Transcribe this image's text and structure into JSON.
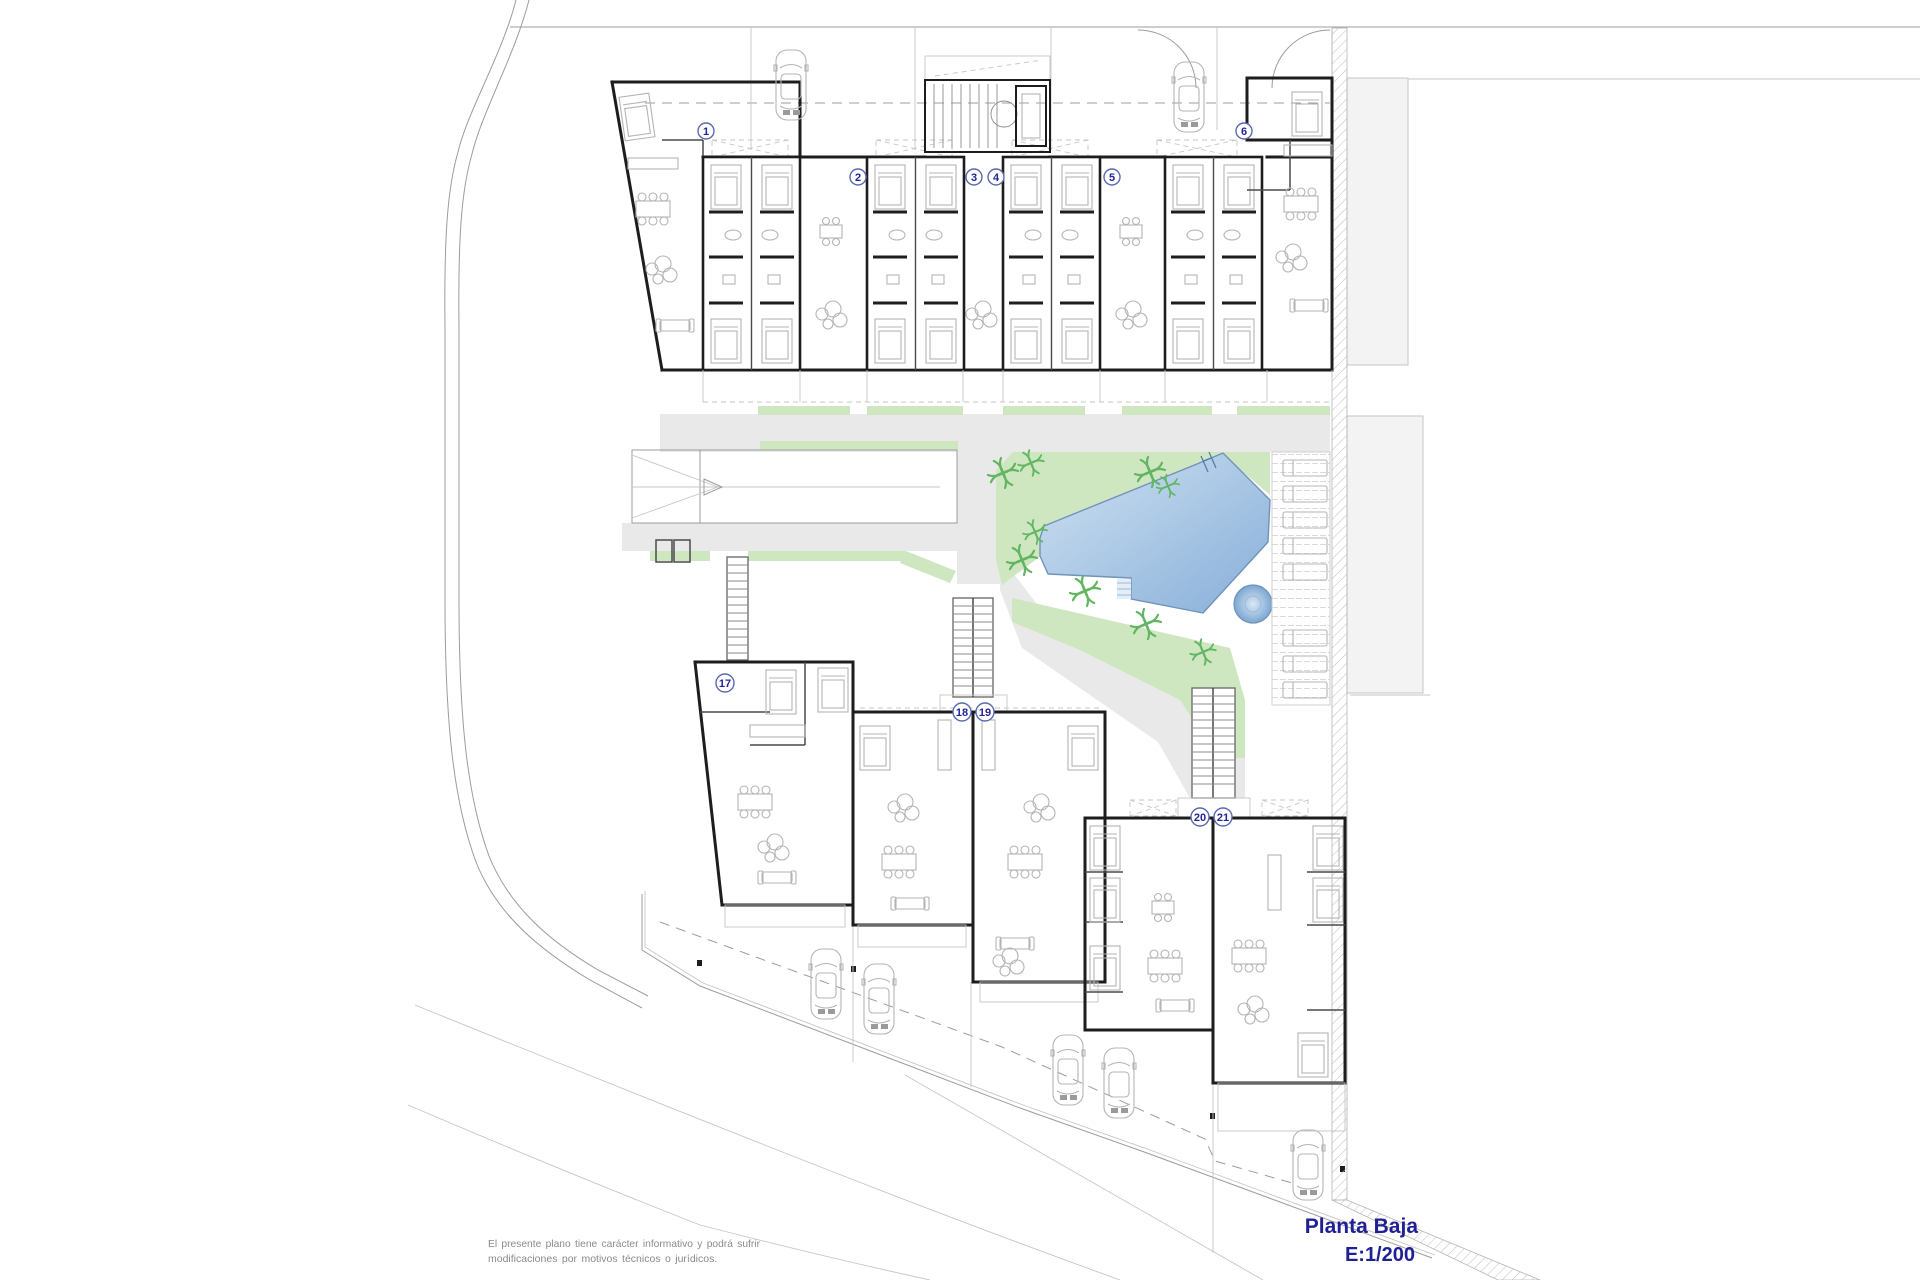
{
  "title_block": {
    "title": "Planta Baja",
    "scale": "E:1/200"
  },
  "disclaimer": {
    "line1": "El presente plano tiene carácter informativo y podrá sufrir",
    "line2": "modificaciones por motivos técnicos o jurídicos."
  },
  "unit_badges": {
    "top": [
      "1",
      "2",
      "3",
      "4",
      "5",
      "6"
    ],
    "bottom": [
      "17",
      "18",
      "19",
      "20",
      "21"
    ]
  },
  "colors": {
    "titleBlue": "#1f1f96",
    "badge": "#5a6ab0",
    "badgeText": "#23239a",
    "disc": "#8a8a8a",
    "wall": "#1d1d1d",
    "wallMid": "#4a4a4a",
    "furn": "#b4b4b4",
    "line": "#9c9c9c",
    "lineLight": "#c6c6c6",
    "path": "#e9e9e9",
    "neighbor": "#f3f3f3",
    "green": "#cfe7c1",
    "leaf": "#62b562",
    "poolLight": "#cfe2f1",
    "poolDark": "#87aed9",
    "poolEdge": "#7093bb",
    "deckLine": "#d6d6d6"
  }
}
